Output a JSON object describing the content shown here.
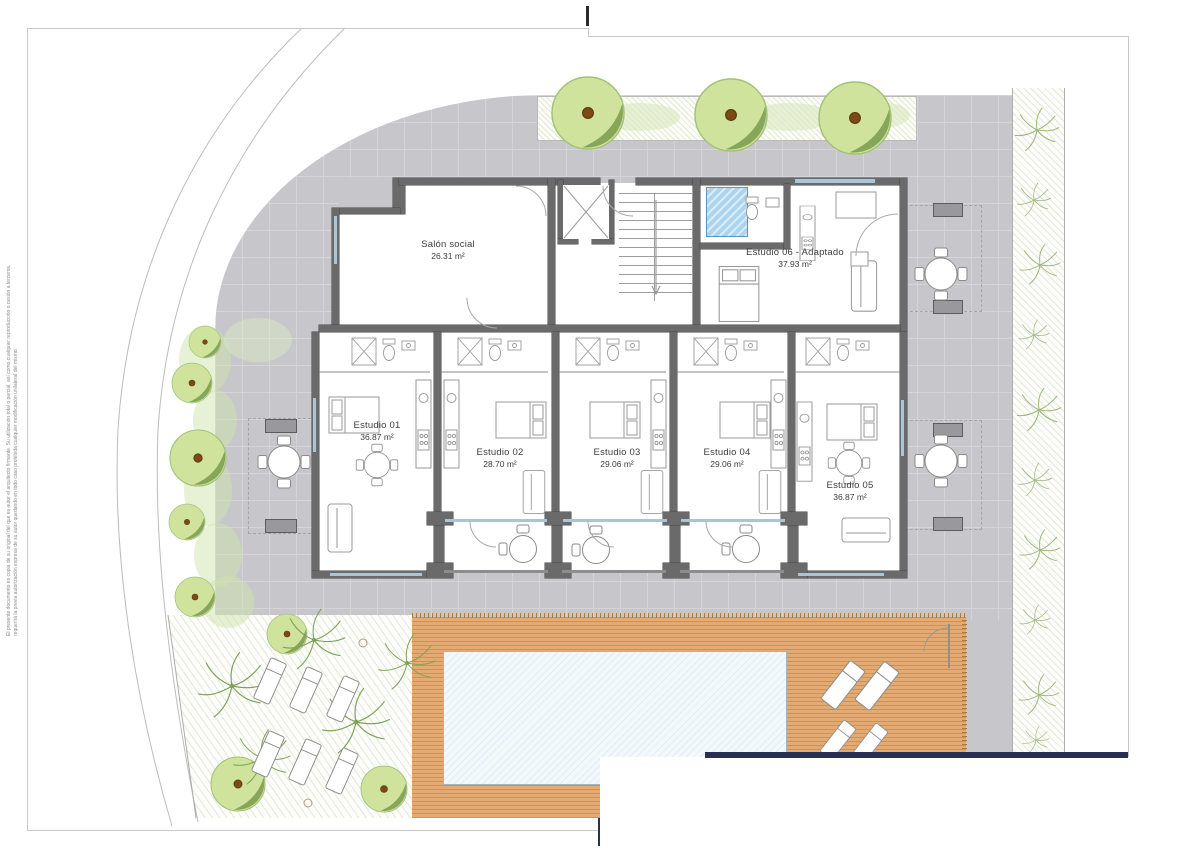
{
  "sheet": {
    "margin_note_line1": "El presente documento es copia de su original del que es autor el arquitecto firmante. Su utilización total o parcial, así como cualquier reproducción o cesión a terceros,",
    "margin_note_line2": "requerirá la previa autorización expresa de su autor quedando en todo caso prohibida cualquier modificación unilateral del mismo."
  },
  "rooms": {
    "salon": {
      "label": "Salón social",
      "area": "26.31 m²"
    },
    "e01": {
      "label": "Estudio 01",
      "area": "36.87 m²"
    },
    "e02": {
      "label": "Estudio 02",
      "area": "28.70 m²"
    },
    "e03": {
      "label": "Estudio 03",
      "area": "29.06 m²"
    },
    "e04": {
      "label": "Estudio 04",
      "area": "29.06 m²"
    },
    "e05": {
      "label": "Estudio 05",
      "area": "36.87 m²"
    },
    "e06": {
      "label": "Estudio 06 - Adaptado",
      "area": "37.93 m²"
    }
  },
  "legend_colors": {
    "paving_grey": "#c7c7cb",
    "wood_deck": "#e3aa74",
    "pool_water": "#f3f9fb",
    "wall_grey": "#6a6a6a",
    "plot_boundary_navy": "#273157",
    "foliage_light": "#cfe39d",
    "foliage_dark": "#87a65a",
    "adapted_shower_blue": "#aad4ef"
  }
}
